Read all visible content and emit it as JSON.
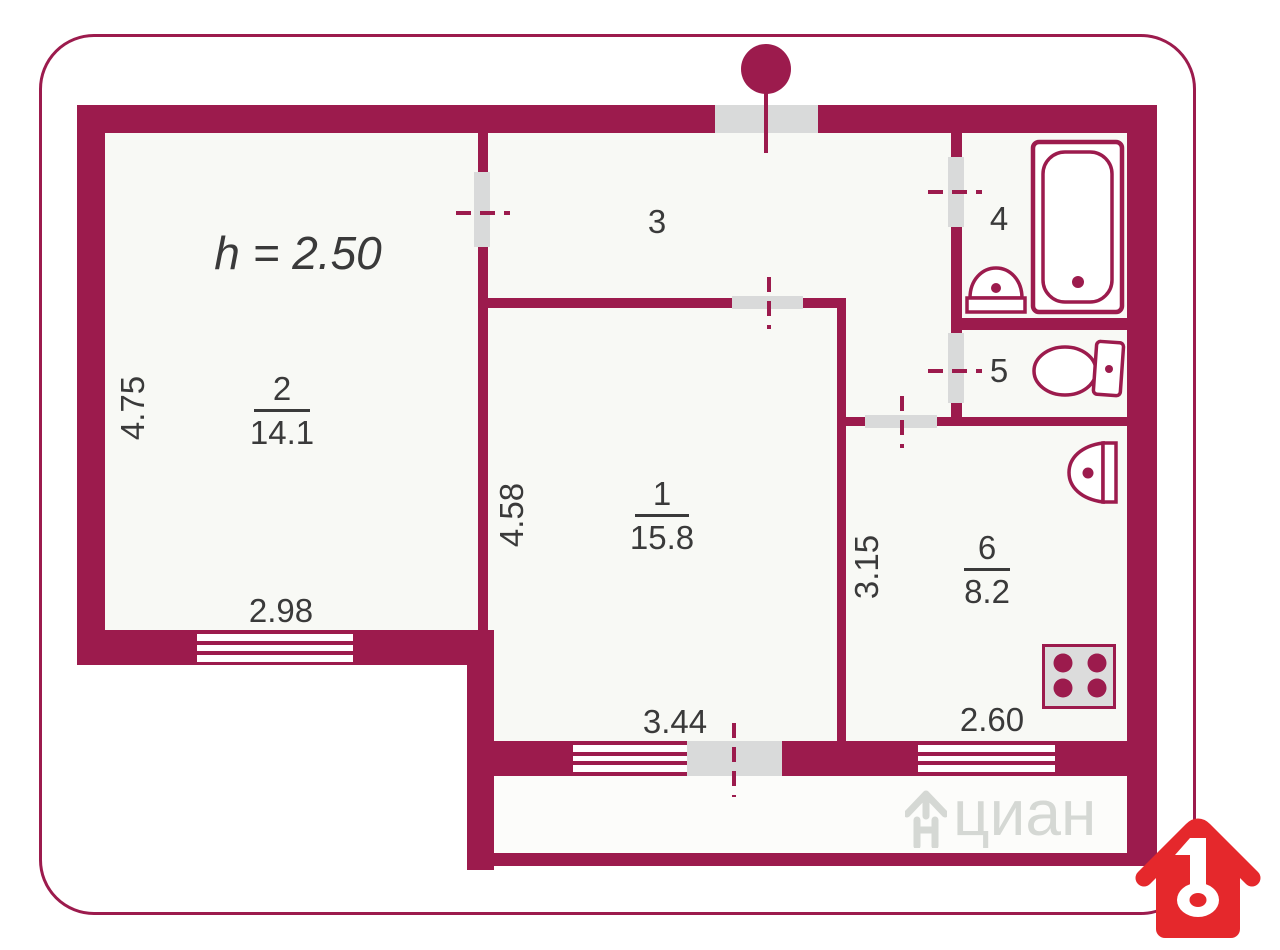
{
  "plan": {
    "height_label": "h = 2.50",
    "rooms": {
      "r1": {
        "number": "1",
        "area": "15.8"
      },
      "r2": {
        "number": "2",
        "area": "14.1"
      },
      "r3": {
        "number": "3"
      },
      "r4": {
        "number": "4"
      },
      "r5": {
        "number": "5"
      },
      "r6": {
        "number": "6",
        "area": "8.2"
      }
    },
    "dimensions": {
      "room2_height": "4.75",
      "room2_width": "2.98",
      "room1_height": "4.58",
      "room1_width": "3.44",
      "kitchen_height": "3.15",
      "kitchen_width": "2.60"
    }
  },
  "watermark": {
    "text": "циан"
  },
  "colors": {
    "wall": "#9c1b4d",
    "logo_red": "#e5282c",
    "opening_gray": "#d9dada",
    "text": "#3a3a3a"
  },
  "icons": [
    "bathtub-icon",
    "bath-sink-icon",
    "toilet-icon",
    "kitchen-sink-icon",
    "stove-icon",
    "entrance-door-icon",
    "cian-house-key-icon",
    "watermark-house-icon"
  ]
}
